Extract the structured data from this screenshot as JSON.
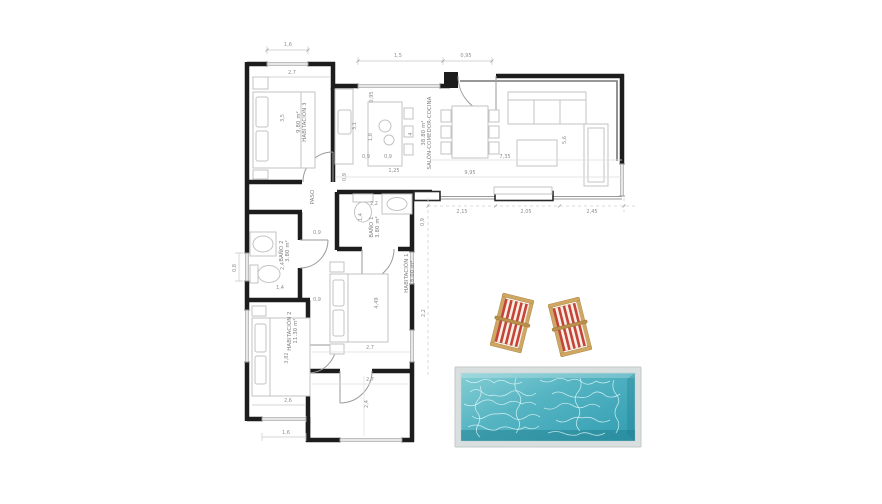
{
  "plan": {
    "rooms": {
      "hab3": {
        "name": "HABITACIÓN 3",
        "area": "9.80 m²"
      },
      "salon": {
        "name": "SALÓN-COMEDOR-COCINA",
        "area": "38.80 m²"
      },
      "paso": {
        "name": "PASO"
      },
      "bano1": {
        "name": "BAÑO 1",
        "area": "3.80 m²"
      },
      "bano2": {
        "name": "BAÑO 2",
        "area": "3.80 m²"
      },
      "hab1": {
        "name": "HABITACIÓN 1",
        "area": "18.00 m²"
      },
      "hab2": {
        "name": "HABITACIÓN 2",
        "area": "11.30 m²"
      }
    },
    "dims": {
      "t16": "1,6",
      "t15": "1,5",
      "t095": "0,95",
      "hab3_w": "2,7",
      "hab3_d": "3,5",
      "k31": "3,1",
      "k18": "1,8",
      "k095": "0,95",
      "k09a": "0,9",
      "k09b": "0,9",
      "k125": "1,25",
      "k09c": "0,9",
      "s4": "4",
      "s56": "5,6",
      "s735": "7,35",
      "s995": "9,95",
      "s215": "2,15",
      "s205": "2,05",
      "s245": "2,45",
      "s09": "0,9",
      "b1_22": "2,2",
      "b1_14": "1,4",
      "p09": "0,9",
      "b2_08": "0,8",
      "b2_24": "2,4",
      "b2_14": "1,4",
      "h2_09": "0,9",
      "h2_382": "3,82",
      "h2_26": "2,6",
      "h2_16": "1,6",
      "h1_449": "4,49",
      "h1_22": "2,2",
      "h1_27a": "2,7",
      "h1_27b": "2,7",
      "ext_24": "2,4"
    },
    "colors": {
      "wall": "#1d1d1d",
      "furniture": "#c3c3c3",
      "dimension_text": "#8f8f8f",
      "pool_water_light": "#84ced4",
      "pool_water_dark": "#3aa0b2",
      "pool_coping": "#d9dede",
      "chair_red": "#c5433a",
      "chair_wood": "#cfa763"
    }
  }
}
